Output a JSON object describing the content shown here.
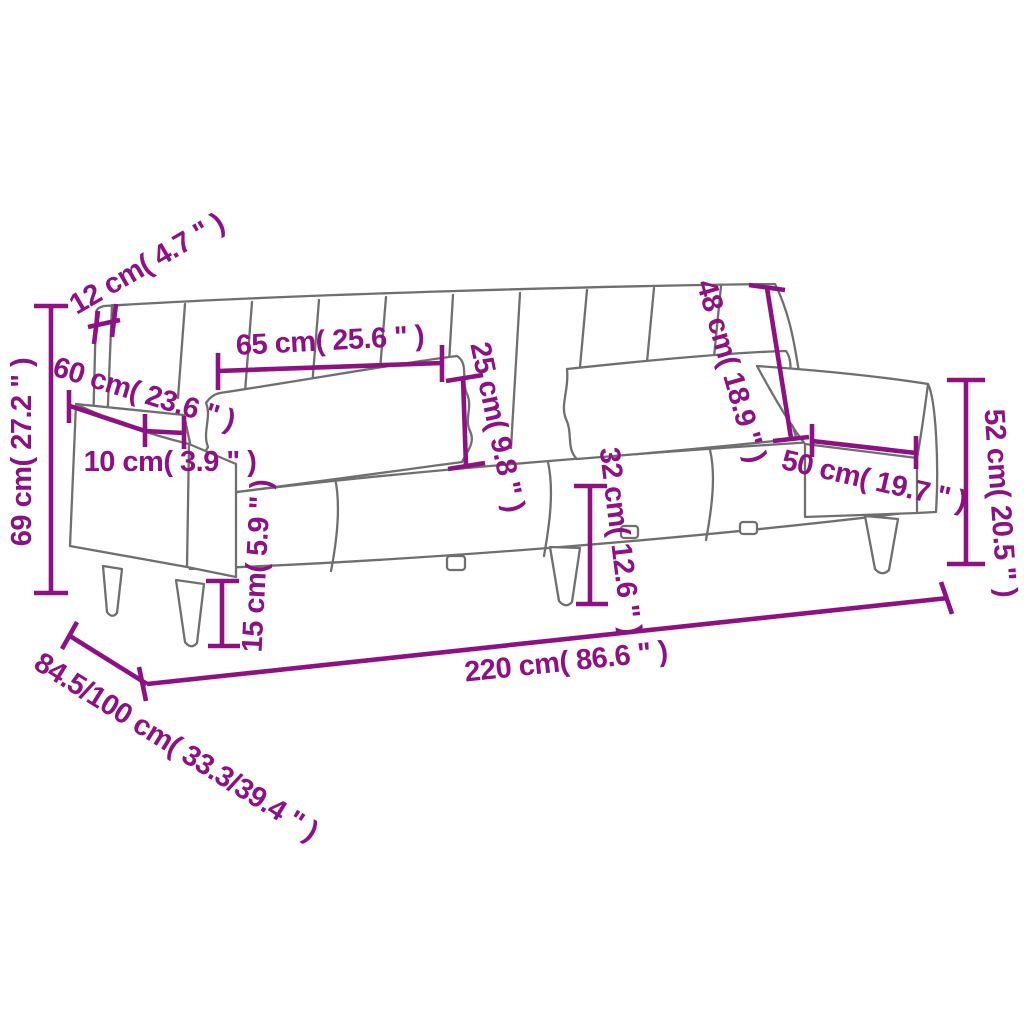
{
  "diagram": {
    "type": "product-dimension-diagram",
    "product": "sofa-bed-with-cushions",
    "unit_style": "cm (inches)",
    "colors": {
      "dimension": "#8D1183",
      "outline": "#6F6F6F",
      "background": "#FFFFFF"
    },
    "measurements": {
      "back_rail_thickness": "12 cm( 4.7 \" )",
      "backrest_section_width": "65 cm( 25.6 \" )",
      "cushion_height": "25 cm( 9.8 \" )",
      "backrest_height": "48 cm( 18.9 \" )",
      "armrest_depth": "60 cm( 23.6 \" )",
      "armrest_width": "10 cm( 3.9 \" )",
      "overall_height": "69 cm( 27.2 \" )",
      "leg_height": "15 cm( 5.9 \" )",
      "seat_height": "32 cm( 12.6 \" )",
      "seat_depth": "50 cm( 19.7 \" )",
      "arm_height": "52 cm( 20.5 \" )",
      "overall_width": "220 cm( 86.6 \" )",
      "overall_depth": "84.5/100 cm( 33.3/39.4 \" )"
    }
  }
}
